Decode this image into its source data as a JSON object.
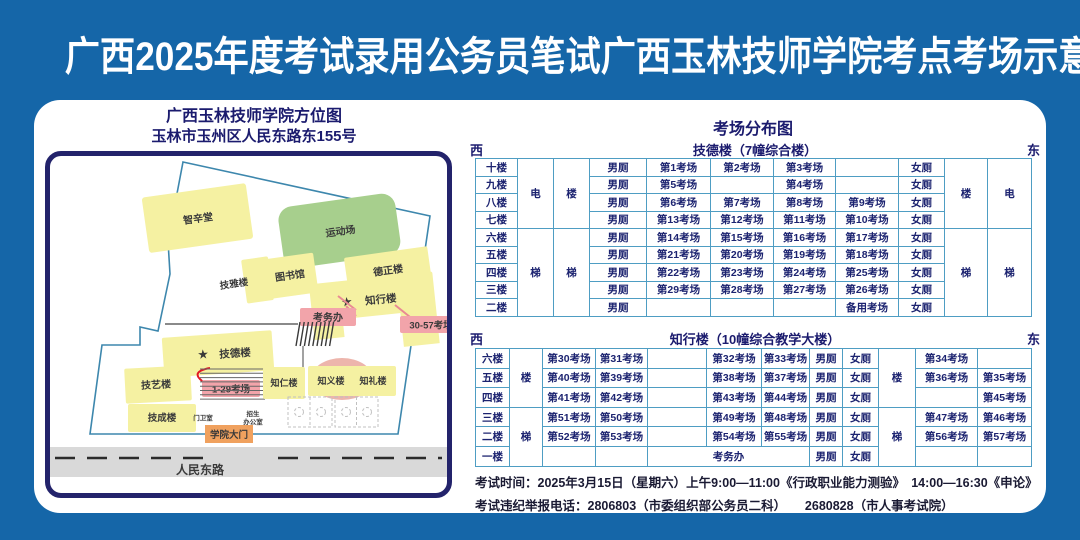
{
  "title": "广西2025年度考试录用公务员笔试广西玉林技师学院考点考场示意图",
  "map": {
    "heading1": "广西玉林技师学院方位图",
    "heading2": "玉林市玉州区人民东路东155号",
    "star": "★",
    "labels": {
      "hall": "智辛堂",
      "sports": "运动场",
      "jiya": "技雅楼",
      "library": "图书馆",
      "dezheng": "德正楼",
      "zhixing": "知行楼",
      "kaowuban": "考务办",
      "rooms_30_57": "30-57考场",
      "garden": "花园",
      "jide": "技德楼",
      "rooms_1_29": "1-29考场",
      "jiyi": "技艺楼",
      "zhiren": "知仁楼",
      "zhiyi": "知义楼",
      "zhili": "知礼楼",
      "jicheng": "技成楼",
      "gatehouse": "门卫室",
      "admissions_l1": "招生",
      "admissions_l2": "办公室",
      "gate": "学院大门",
      "road": "人民东路"
    }
  },
  "distribution": {
    "heading": "考场分布图",
    "west": "西",
    "east": "东",
    "table1": {
      "building": "技德楼（7幢综合楼）",
      "toilet_m": "男厕",
      "toilet_f": "女厕",
      "top_span": 4,
      "west_cols": [
        {
          "top": "电",
          "bottom": "梯"
        },
        {
          "top": "楼",
          "bottom": "梯"
        }
      ],
      "east_cols": [
        {
          "top": "楼",
          "bottom": "梯"
        },
        {
          "top": "电",
          "bottom": "梯"
        }
      ],
      "rows": [
        {
          "floor": "十楼",
          "exams": [
            "第1考场",
            "第2考场",
            "第3考场",
            ""
          ]
        },
        {
          "floor": "九楼",
          "exams": [
            "第5考场",
            "",
            "第4考场",
            ""
          ]
        },
        {
          "floor": "八楼",
          "exams": [
            "第6考场",
            "第7考场",
            "第8考场",
            "第9考场"
          ]
        },
        {
          "floor": "七楼",
          "exams": [
            "第13考场",
            "第12考场",
            "第11考场",
            "第10考场"
          ]
        },
        {
          "floor": "六楼",
          "exams": [
            "第14考场",
            "第15考场",
            "第16考场",
            "第17考场"
          ]
        },
        {
          "floor": "五楼",
          "exams": [
            "第21考场",
            "第20考场",
            "第19考场",
            "第18考场"
          ]
        },
        {
          "floor": "四楼",
          "exams": [
            "第22考场",
            "第23考场",
            "第24考场",
            "第25考场"
          ]
        },
        {
          "floor": "三楼",
          "exams": [
            "第29考场",
            "第28考场",
            "第27考场",
            "第26考场"
          ]
        },
        {
          "floor": "二楼",
          "exams": [
            "",
            "",
            "",
            "备用考场"
          ]
        }
      ]
    },
    "table2": {
      "building": "知行楼（10幢综合教学大楼）",
      "toilet_m": "男厕",
      "toilet_f": "女厕",
      "top_span": 3,
      "office": "考务办",
      "stair_west": {
        "top": "楼",
        "bottom": "梯"
      },
      "stair_east": {
        "top": "楼",
        "bottom": "梯"
      },
      "rows": [
        {
          "floor": "六楼",
          "exams": [
            "第30考场",
            "第31考场",
            "第32考场",
            "第33考场",
            "第34考场",
            ""
          ]
        },
        {
          "floor": "五楼",
          "exams": [
            "第40考场",
            "第39考场",
            "第38考场",
            "第37考场",
            "第36考场",
            "第35考场"
          ]
        },
        {
          "floor": "四楼",
          "exams": [
            "第41考场",
            "第42考场",
            "第43考场",
            "第44考场",
            "",
            "第45考场"
          ]
        },
        {
          "floor": "三楼",
          "exams": [
            "第51考场",
            "第50考场",
            "第49考场",
            "第48考场",
            "第47考场",
            "第46考场"
          ]
        },
        {
          "floor": "二楼",
          "exams": [
            "第52考场",
            "第53考场",
            "第54考场",
            "第55考场",
            "第56考场",
            "第57考场"
          ]
        },
        {
          "floor": "一楼",
          "exams": [
            "",
            "",
            "",
            "",
            "",
            ""
          ],
          "office_row": true
        }
      ]
    }
  },
  "footer": {
    "line1": "考试时间：2025年3月15日（星期六）上午9:00—11:00《行政职业能力测验》　14:00—16:30《申论》",
    "line2": "考试违纪举报电话：2806803（市委组织部公务员二科）　　2680828（市人事考试院）"
  },
  "colors": {
    "background": "#1566a8",
    "panel": "#ffffff",
    "navy_text": "#1b1b6e",
    "table_border": "#4e9dc3",
    "table_text": "#1c2370",
    "building_yellow": "#f5f1a2",
    "field_green": "#a7cf8d",
    "callout_pink": "#f2a4aa",
    "callout_red_text": "#e11925",
    "gate_orange": "#f0a15e",
    "road_gray": "#d9d9d9"
  }
}
